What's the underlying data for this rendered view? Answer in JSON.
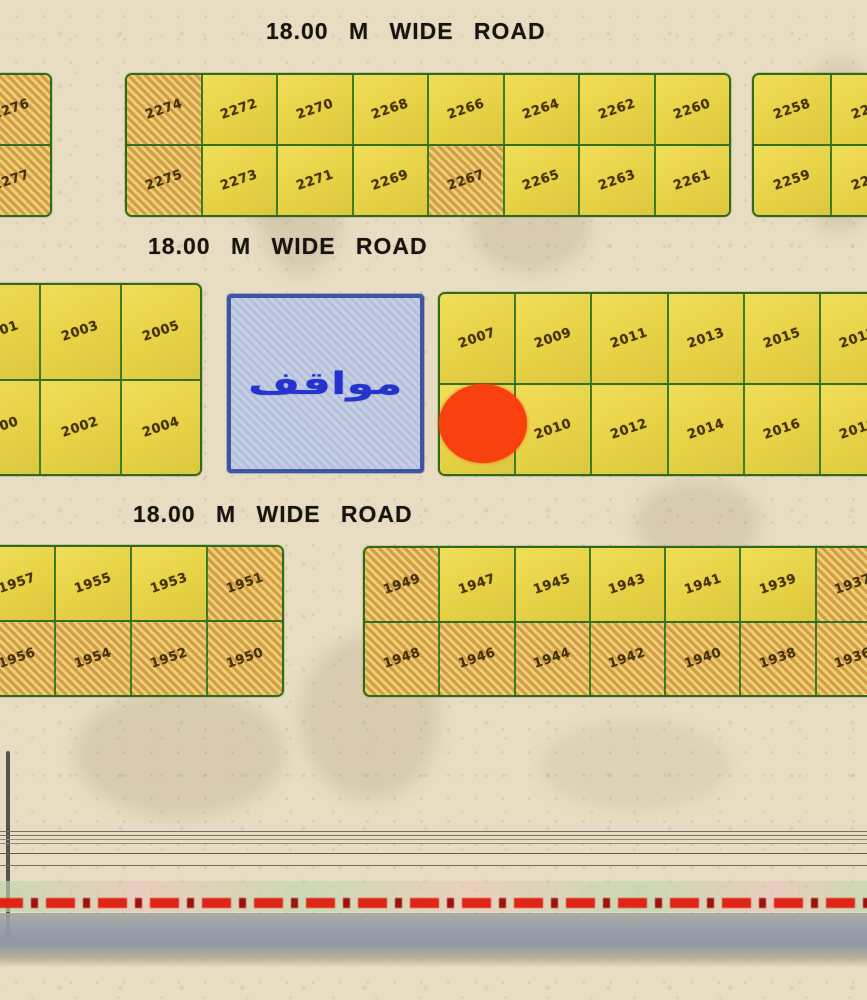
{
  "roads": [
    {
      "label": "18.00 M WIDE ROAD",
      "width_m": "18.00"
    },
    {
      "label": "18.00 M WIDE ROAD",
      "width_m": "18.00"
    },
    {
      "label": "18.00 M WIDE ROAD",
      "width_m": "18.00"
    }
  ],
  "parking": {
    "label": "مواقف"
  },
  "marker": {
    "shape": "ellipse",
    "color": "#f8410f"
  },
  "colors": {
    "sand": "#e8ddc2",
    "plot_yellow": "#e9d54a",
    "plot_hatch_orange": "#d9a94f",
    "block_border_green": "#2f6a1d",
    "parking_fill": "#b5c0da",
    "parking_border": "#3e55a5",
    "parking_text": "#2433cd",
    "road_text": "#181510",
    "plot_number_text": "#46320a",
    "dash_line_red": "#e02517",
    "band_gray": "#8e97a7"
  },
  "blocks": [
    {
      "id": "top-left-edge",
      "rows": [
        [
          {
            "n": "2276",
            "h": true
          }
        ],
        [
          {
            "n": "2277",
            "h": true
          }
        ]
      ]
    },
    {
      "id": "top-main",
      "rows": [
        [
          {
            "n": "2274",
            "h": true
          },
          {
            "n": "2272"
          },
          {
            "n": "2270"
          },
          {
            "n": "2268"
          },
          {
            "n": "2266"
          },
          {
            "n": "2264"
          },
          {
            "n": "2262"
          },
          {
            "n": "2260"
          }
        ],
        [
          {
            "n": "2275",
            "h": true
          },
          {
            "n": "2273"
          },
          {
            "n": "2271"
          },
          {
            "n": "2269"
          },
          {
            "n": "2267",
            "h": true
          },
          {
            "n": "2265"
          },
          {
            "n": "2263"
          },
          {
            "n": "2261"
          }
        ]
      ]
    },
    {
      "id": "top-right-edge",
      "rows": [
        [
          {
            "n": "2258"
          },
          {
            "n": "2256"
          }
        ],
        [
          {
            "n": "2259"
          },
          {
            "n": "2257"
          }
        ]
      ]
    },
    {
      "id": "mid-left",
      "rows": [
        [
          {
            "n": "2001"
          },
          {
            "n": "2003"
          },
          {
            "n": "2005"
          }
        ],
        [
          {
            "n": "2000"
          },
          {
            "n": "2002"
          },
          {
            "n": "2004"
          }
        ]
      ]
    },
    {
      "id": "mid-right",
      "rows": [
        [
          {
            "n": "2007"
          },
          {
            "n": "2009"
          },
          {
            "n": "2011"
          },
          {
            "n": "2013"
          },
          {
            "n": "2015"
          },
          {
            "n": "2017"
          }
        ],
        [
          {
            "n": ""
          },
          {
            "n": "2010"
          },
          {
            "n": "2012"
          },
          {
            "n": "2014"
          },
          {
            "n": "2016"
          },
          {
            "n": "2018"
          }
        ]
      ]
    },
    {
      "id": "bot-left",
      "rows": [
        [
          {
            "n": "1957"
          },
          {
            "n": "1955"
          },
          {
            "n": "1953"
          },
          {
            "n": "1951",
            "h": true
          }
        ],
        [
          {
            "n": "1956",
            "h": true
          },
          {
            "n": "1954",
            "h": true
          },
          {
            "n": "1952",
            "h": true
          },
          {
            "n": "1950",
            "h": true
          }
        ]
      ]
    },
    {
      "id": "bot-right",
      "rows": [
        [
          {
            "n": "1949",
            "h": true
          },
          {
            "n": "1947"
          },
          {
            "n": "1945"
          },
          {
            "n": "1943"
          },
          {
            "n": "1941"
          },
          {
            "n": "1939"
          },
          {
            "n": "1937",
            "h": true
          }
        ],
        [
          {
            "n": "1948",
            "h": true
          },
          {
            "n": "1946",
            "h": true
          },
          {
            "n": "1944",
            "h": true
          },
          {
            "n": "1942",
            "h": true
          },
          {
            "n": "1940",
            "h": true
          },
          {
            "n": "1938",
            "h": true
          },
          {
            "n": "1936",
            "h": true
          }
        ]
      ]
    }
  ]
}
